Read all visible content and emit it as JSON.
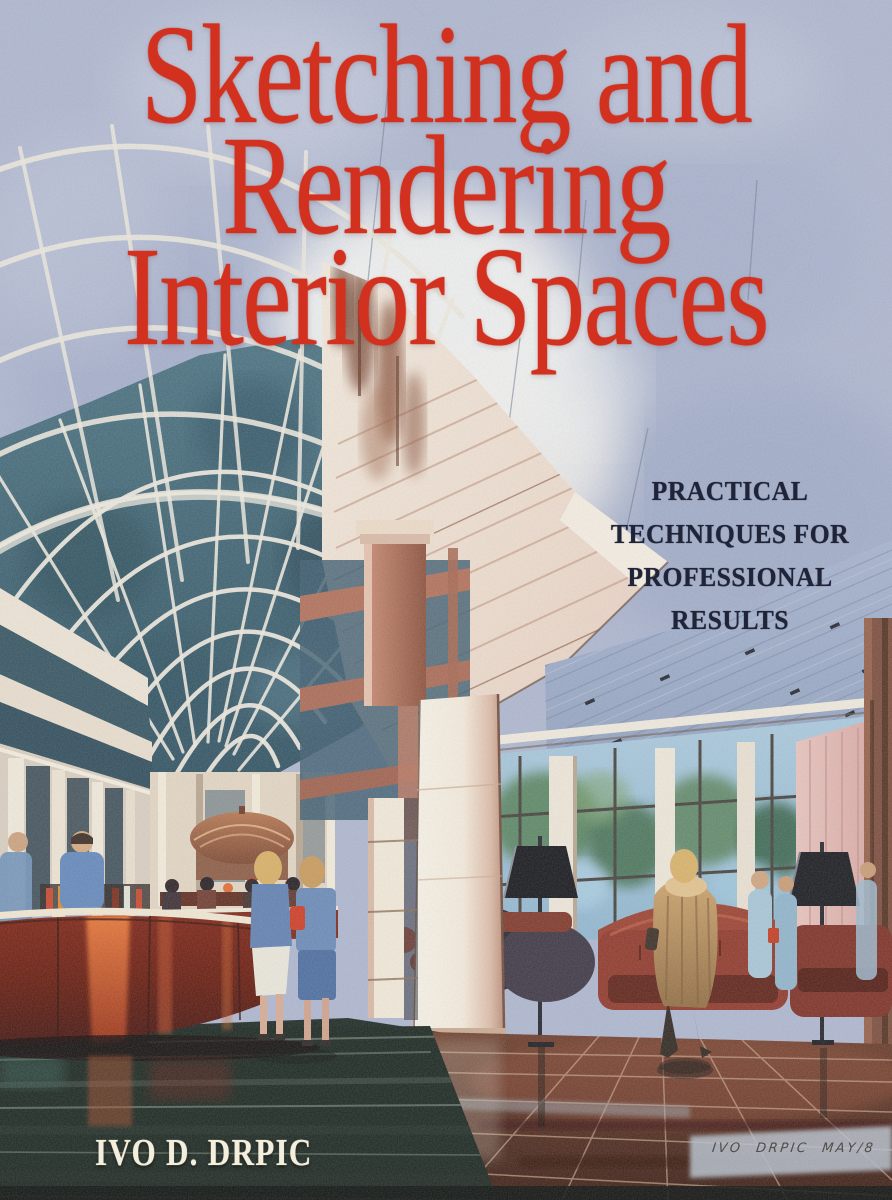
{
  "book_cover": {
    "title": {
      "lines": [
        "Sketching and",
        "Rendering",
        "Interior Spaces"
      ]
    },
    "subtitle": {
      "lines": [
        "PRACTICAL",
        "TECHNIQUES FOR",
        "PROFESSIONAL",
        "RESULTS"
      ]
    },
    "author": "IVO D. DRPIC",
    "artist_signature": "IVO DRPIC MAY/8",
    "illustration": {
      "description": "Watercolor architectural rendering of a hotel atrium interior: curved glass barrel-vault skylight at left, cream canopy and columns at center, hatched blue lobby ceiling with downlights at right, window wall with greenery, maroon sofas and black floor lamps, curved glossy red bar at lower left, figures walking on a dark reflective tile floor"
    },
    "palette": {
      "background_blue": "#adb5cd",
      "title_red": "#d2311f",
      "subtitle_navy": "#1f2438",
      "author_cream": "#f4eedd",
      "glass_teal": "#3c6274",
      "rib_white": "#ece7db",
      "canopy_cream": "#f0e5d6",
      "brick_column": "#b5765f",
      "ceiling_blue": "#9aa8c6",
      "window_glass": "#a9c8da",
      "foliage_green": "#4f7c50",
      "sofa_maroon": "#8e3526",
      "bar_red": "#6e1a0e",
      "bar_sheen_orange": "#ef7a36",
      "floor_dark_green": "#18231b",
      "floor_brown": "#6b3a26",
      "curtain_pink": "#e3b8b4",
      "coat_tan": "#c69a5f"
    }
  },
  "theme": {
    "--cover-blue": "#adb5cd",
    "--title-red": "#d2311f",
    "--subtitle-navy": "#1f2438",
    "--author-cream": "#f4eedd",
    "--signature-ink": "#45403c"
  }
}
